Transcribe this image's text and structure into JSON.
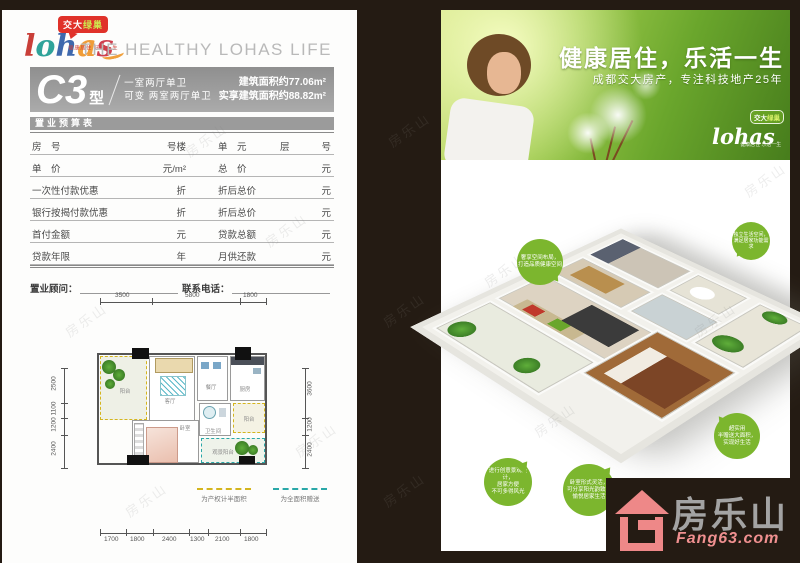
{
  "watermark": "房乐山",
  "colors": {
    "frame": "#241b13",
    "bubble_green": "#7cb62e",
    "banner_gray": "#9b9b9b",
    "logo_red": "#e0322a",
    "fang_pink": "#f09090"
  },
  "left_page": {
    "logo": {
      "letters": [
        "l",
        "o",
        "h",
        "a",
        "s"
      ],
      "bubble_part1": "交大",
      "bubble_part2": "绿巢",
      "tagline": "健康居住 乐活一生"
    },
    "header_en": "THE HEALTHY LOHAS LIFE",
    "unit_banner": {
      "code": "C3",
      "suffix": "型",
      "line1": "一室两厅单卫",
      "line2": "可变 两室两厅单卫",
      "area1": "建筑面积约77.06m²",
      "area2": "实享建筑面积约88.82m²"
    },
    "budget_table": {
      "title": "置业预算表",
      "rows": [
        {
          "l1": "房　号",
          "u1": "号楼",
          "l2": "单　元",
          "mid": "层",
          "u2": "号"
        },
        {
          "l1": "单　价",
          "u1": "元/m²",
          "l2": "总　价",
          "u2": "元"
        },
        {
          "l1": "一次性付款优惠",
          "u1": "折",
          "l2": "折后总价",
          "u2": "元"
        },
        {
          "l1": "银行按揭付款优惠",
          "u1": "折",
          "l2": "折后总价",
          "u2": "元"
        },
        {
          "l1": "首付金额",
          "u1": "元",
          "l2": "贷款总额",
          "u2": "元"
        },
        {
          "l1": "贷款年限",
          "u1": "年",
          "l2": "月供还款",
          "u2": "元"
        }
      ],
      "footer": {
        "advisor": "置业顾问：",
        "phone": "联系电话："
      }
    },
    "floorplan": {
      "dims_top": [
        "3500",
        "5800",
        "1800"
      ],
      "dims_bottom": [
        "1700",
        "1800",
        "2400",
        "1300",
        "2100",
        "1800"
      ],
      "dims_left": [
        "2500",
        "1100",
        "1200",
        "2400"
      ],
      "dims_right": [
        "3600",
        "1200",
        "2400"
      ],
      "rooms": {
        "balcony": "阳台",
        "living": "客厅",
        "dining": "餐厅",
        "kitchen": "厨房",
        "bath": "卫生间",
        "balcony2": "阳台",
        "bedroom": "卧室",
        "view_balcony": "观景阳台"
      },
      "legend": [
        {
          "label": "为产权计半面积"
        },
        {
          "label": "为全面积赠送"
        }
      ]
    }
  },
  "right_page": {
    "hero": {
      "headline": "健康居住，乐活一生",
      "subline": "成都交大房产，专注科技地产25年",
      "logo_word": "lohas",
      "logo_bubble1": "交大",
      "logo_bubble2": "绿巢",
      "logo_tagline": "健康居住 乐活一生"
    },
    "callouts": [
      {
        "lines": [
          "奢享空间布局，",
          "打造品质健康空间",
          ""
        ]
      },
      {
        "lines": [
          "独立生活空间，",
          "满足居家功能需求",
          ""
        ]
      },
      {
        "lines": [
          "进行创意景观设计，",
          "居家方便",
          "不可多得风光"
        ]
      },
      {
        "lines": [
          "卧室形式灵活，",
          "可分享阳光韵致，",
          "愉悦居家生活"
        ]
      },
      {
        "lines": [
          "超实用",
          "半赠送大面积，",
          "实现好生活"
        ]
      }
    ]
  },
  "brand_footer": {
    "name": "房乐山",
    "site": "Fang63.com"
  }
}
